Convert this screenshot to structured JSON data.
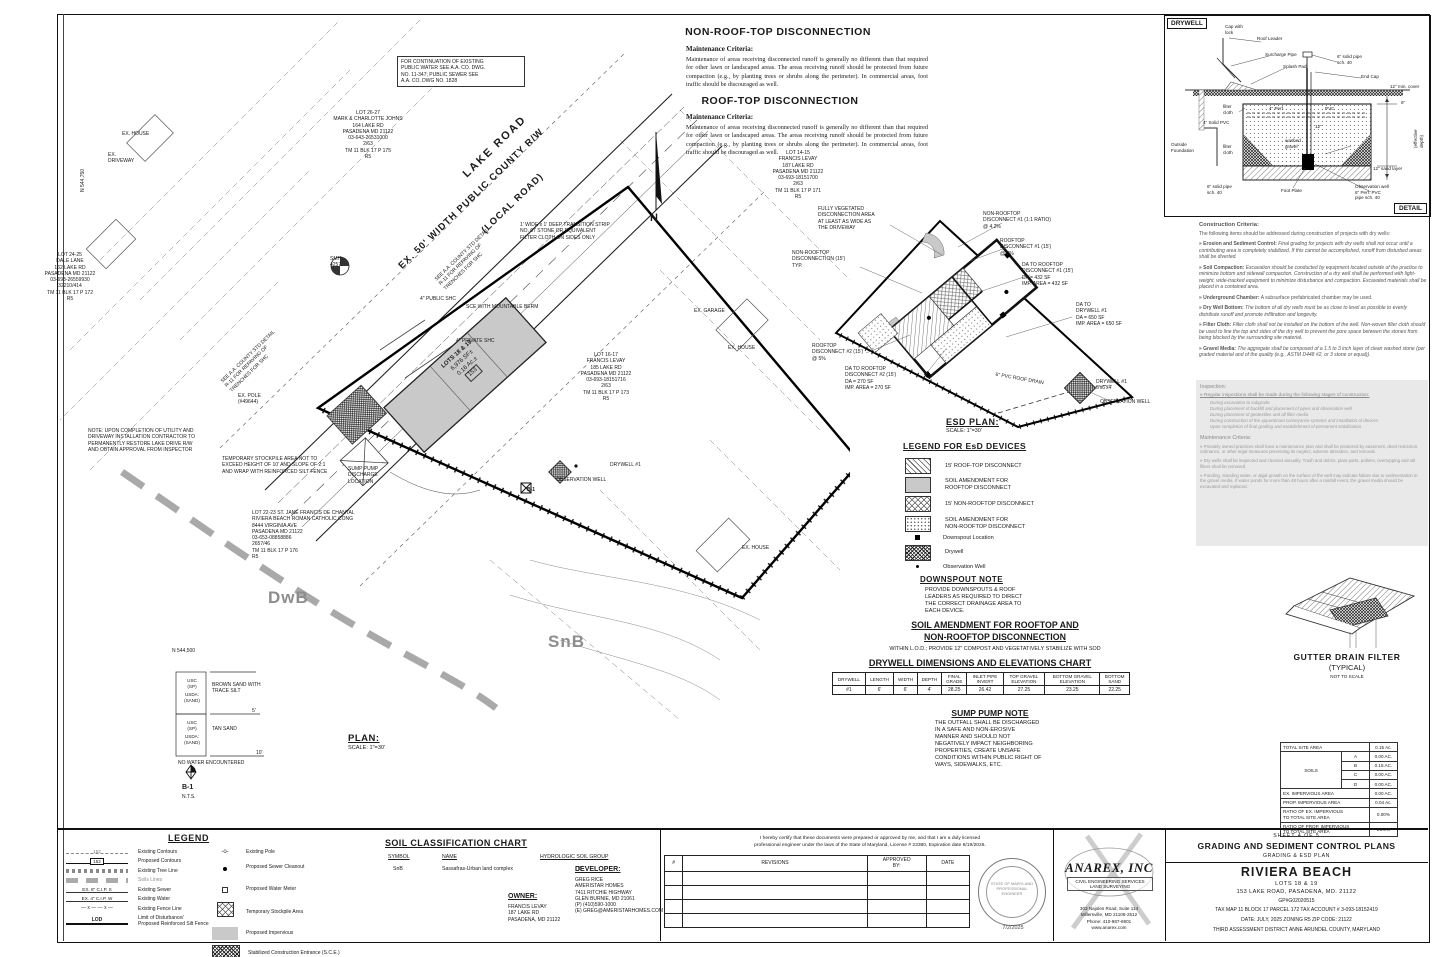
{
  "top_notes": {
    "non_rooftop_title": "NON-ROOF-TOP DISCONNECTION",
    "maintenance_label": "Maintenance Criteria:",
    "non_rooftop_body": "Maintenance of areas receiving disconnected runoff is generally no different than that required for other lawn or landscaped areas.  The areas receiving runoff should be protected from future compaction (e.g., by planting trees or shrubs along the perimeter).  In commercial areas, foot traffic should be discouraged as well.",
    "rooftop_title": "ROOF-TOP DISCONNECTION",
    "rooftop_body": "Maintenance of areas receiving disconnected runoff is generally no different than that required for other lawn or landscaped areas.  The areas receiving runoff should be protected from future compaction (e.g., by planting trees or shrubs along the perimeter).  In commercial areas, foot traffic should be discouraged as well."
  },
  "drywell_detail": {
    "title": "DRYWELL",
    "detail_label": "DETAIL",
    "labels": {
      "roof_leader": "Roof Leader",
      "surcharge_pipe": "Surcharge Pipe",
      "splash_pad": "Splash Pad",
      "cap": "Cap with\nlock",
      "solid_pipe_6": "6\" solid pipe\nsch. 40",
      "end_cap": "End Cap",
      "min_cover": "12\" min. cover",
      "filter_cloth_top": "filter\ncloth",
      "solid_pvc": "4\" Solid PVC",
      "perf_pvc": "4\" Perf.",
      "pvc": "PVC",
      "six_in": "6\"",
      "twelve_in": "12\"",
      "effective_depth": "(effective depth)",
      "outside_foundation": "Outside\nFoundation",
      "filter_cloth_side": "filter\ncloth",
      "washed_gravel": "washed\ngravel",
      "sand_layer": "12\" sand layer",
      "foot_plate": "Foot Plate",
      "observation_well": "Observation well\n6\" Perf. PVC\npipe sch. 40",
      "solid_pipe_bottom": "6\" solid pipe\nsch. 40"
    }
  },
  "criteria": {
    "title": "Construction Criteria:",
    "intro": "The following items should be addressed during construction of projects with dry wells:",
    "items": [
      {
        "name": "Erosion and Sediment Control:",
        "text": "Final grading for projects with dry wells shall not occur until a contributing area is completely stabilized.  If this cannot be accomplished, runoff from disturbed areas shall be diverted."
      },
      {
        "name": "Soil Compaction:",
        "text": "Excavation should be conducted by equipment located outside of the practice to minimize bottom and sidewall compaction.  Construction of a dry well shall be performed with light-weight, wide-tracked equipment to minimize disturbance and compaction.  Excavated materials shall be placed in a contained area."
      },
      {
        "name": "Underground Chamber:",
        "text": "A subsurface prefabricated chamber may be used."
      },
      {
        "name": "Dry Well Bottom:",
        "text": "The bottom of all dry wells must be as close to level as possible to evenly distribute runoff and promote infiltration and longevity."
      },
      {
        "name": "Filter Cloth:",
        "text": "Filter cloth shall not be installed on the bottom of the well.  Non-woven filter cloth should be used to line the top and sides of the dry well to prevent the pore space between the stones from being blocked by the surrounding site material."
      },
      {
        "name": "Gravel Media:",
        "text": "The aggregate shall be composed of a 1.5 to 3 inch layer of clean washed stone (per graded material and of the quality (e.g., ASTM D448 #2, or 3 stone or equal))."
      }
    ],
    "inspection_title": "Inspection:",
    "inspection_intro": "Regular inspections shall be made during the following stages of construction:",
    "inspection_items": [
      "During excavation to subgrade",
      "During placement of backfill and placement of pipes and observation well",
      "During placement of geotextiles and all filter media",
      "During construction of the appurtenant conveyance systems and installation of devices",
      "Upon completion of final grading and establishment of permanent stabilization"
    ],
    "maintenance_title": "Maintenance Criteria:",
    "maintenance_items": [
      "Privately owned practices shall have a maintenance plan and shall be protected by easement, deed restriction, ordinance, or other legal measures preventing its neglect, adverse alteration, and removal.",
      "Dry wells shall be inspected and cleaned annually.  Trash and debris, plant parts, pollens, overtopping and silt filters shall be removed.",
      "Ponding, standing water, or algal growth on the surface of the well may indicate failure due to sedimentation in the gravel media.  If water ponds for more than 48 hours after a rainfall event, the gravel media should be excavated and replaced."
    ]
  },
  "plan": {
    "title": "PLAN:",
    "scale": "SCALE: 1\"=30'",
    "road_label_1": "LAKE ROAD",
    "road_label_2": "EX. 50' WIDTH PUBLIC COUNTY R/W",
    "road_label_3": "(LOCAL ROAD)",
    "north_label": "N",
    "soil_dwb": "DwB",
    "soil_snb": "SnB",
    "building": {
      "line1": "LOTS 18 & 19",
      "line2": "6,976 SF±",
      "line3": "0.16 Ac.±",
      "addr": "153"
    },
    "labels": [
      "FOR CONTINUATION OF EXISTING\nPUBLIC WATER SEE A.A. CO. DWG.\nNO. 11-347; PUBLIC SEWER SEE\nA.A. CO. DWG NO. 1828",
      "LOT 26-27\nMARK & CHARLOTTE JOHNS\n164 LAKE RD\nPASADENA MD 21122\n03-643-26531000\n2/63\nTM 11 BLK 17 P 175\nR5",
      "EX. HOUSE",
      "EX.\nDRIVEWAY",
      "LOT 24-25\nDALE LANE\n162 LAKE RD\nPASADENA MD 21122\n03-693-26559930\n32210/414\nTM 11 BLK 17 P 172\nR5",
      "LOT 14-15\nFRANCIS LEVAY\n187 LAKE RD\nPASADENA MD 21122\n03-693-18151700\n2/63\nTM 11 BLK 17 P 171\nR5",
      "LOT 16-17\nFRANCIS LEVAY\n185 LAKE RD\nPASADENA MD 21122\n03-693-18151716\n2/63\nTM 11 BLK 17 P 173\nR5",
      "SMH\n4257",
      "4\" PUBLIC SHC",
      "SCE WITH MOUNTABLE BERM",
      "1' WIDE x 1' DEEP TRANSITION STRIP\nNO. 67 STONE OR EQUIVALENT\nFILTER CLOTH ON SIDES ONLY",
      "4\" PRIVATE SHC",
      "NOTE: UPON COMPLETION OF UTILITY AND\nDRIVEWAY INSTALLATION CONTRACTOR TO\nPERMANENTLY RESTORE LAKE DRIVE R/W\nAND OBTAIN APPROVAL FROM INSPECTOR",
      "TEMPORARY STOCKPILE AREA NOT TO\nEXCEED HEIGHT OF 10' AND SLOPE OF 2:1\nAND WRAP WITH REINFORCED SILT FENCE",
      "SUMP PUMP\nDISCHARGE\nLOCATION",
      "DRYWELL #1",
      "OBSERVATION WELL",
      "B-1",
      "LOT 22-23 ST. JANE FRANCIS DE CHANTAL\nRIVIERA BEACH ROMAN CATHOLIC CONG\n8444 VIRGINIA AVE\nPASADENA MD 21122\n03-653-08858886\n2657/46\nTM 11 BLK 17 P 176\nR5",
      "EX. POLE\n(#49644)",
      "EX. HOUSE",
      "EX. GARAGE",
      "N 544,750",
      "N 544,500",
      "SEE A.A. COUNTY STD DETAIL\nR-11 FOR REPAVING OF\nTRENCHES FOR SHC",
      "EX. HOUSE"
    ],
    "boring": {
      "usc": "USC\n(SP)",
      "usda": "USDA:\n(SAND)",
      "layer1": "BROWN SAND WITH\nTRACE SILT",
      "layer2": "TAN SAND",
      "d1": "5'",
      "d2": "10'",
      "no_water": "NO WATER ENCOUNTERED",
      "name": "B-1",
      "nts": "N.T.S."
    }
  },
  "esd": {
    "title": "ESD PLAN:",
    "scale": "SCALE: 1\"=30'",
    "callouts": [
      "FULLY VEGETATED\nDISCONNECTION AREA\nAT LEAST AS WIDE AS\nTHE DRIVEWAY",
      "NON-ROOFTOP\nDISCONNECT #1 (1:1 RATIO)\n@ 4.2%",
      "ROOFTOP\nDISCONNECT #1 (15')\n@ 2%",
      "DA TO ROOFTOP\nDISCONNECT #1 (15')\nDA = 432 SF\nIMP. AREA = 432 SF",
      "DA TO\nDRYWELL #1\nDA = 650 SF\nIMP. AREA = 650 SF",
      "NON-ROOFTOP\nDISCONNECTION (15')\nTYP.",
      "ROOFTOP\nDISCONNECT #2 (15')\n@ 5%",
      "DA TO ROOFTOP\nDISCONNECT #2 (15')\nDA = 270 SF\nIMP. AREA = 270 SF",
      "6\" PVC ROOF DRAIN",
      "DRYWELL #1\n6'x6'x4'",
      "OBSERVATION WELL"
    ]
  },
  "esd_legend": {
    "title": "LEGEND FOR EsD DEVICES",
    "items": [
      "15' ROOF-TOP DISCONNECT",
      "SOIL AMENDMENT FOR\nROOFTOP DISCONNECT",
      "15' NON-ROOFTOP DISCONNECT",
      "SOIL AMENDMENT FOR\nNON-ROOFTOP DISCONNECT",
      "Downspout Location",
      "Drywell",
      "Observation Well"
    ]
  },
  "notes2": {
    "downspout_title": "DOWNSPOUT NOTE",
    "downspout_body": "PROVIDE DOWNSPOUTS & ROOF\nLEADERS AS REQUIRED TO DIRECT\nTHE CORRECT DRAINAGE AREA TO\nEACH DEVICE.",
    "soil_amend_title1": "SOIL AMENDMENT FOR ROOFTOP AND",
    "soil_amend_title2": "NON-ROOFTOP DISCONNECTION",
    "soil_amend_body": "WITHIN L.O.D.; PROVIDE 12\" COMPOST AND VEGETATIVELY STABILIZE WITH SOD",
    "sump_title": "SUMP PUMP NOTE",
    "sump_body": "THE OUTFALL SHALL BE DISCHARGED\nIN A SAFE AND NON-EROSIVE\nMANNER AND SHOULD NOT\nNEGATIVELY IMPACT NEIGHBORING\nPROPERTIES, CREATE UNSAFE\nCONDITIONS WITHIN PUBLIC RIGHT OF\nWAYS, SIDEWALKS, ETC."
  },
  "drywell_chart": {
    "title": "DRYWELL DIMENSIONS AND ELEVATIONS CHART",
    "headers": [
      "DRYWELL",
      "LENGTH",
      "WIDTH",
      "DEPTH",
      "FINAL\nGRADE",
      "INLET PIPE\nINVERT",
      "TOP GRAVEL\nELEVATION",
      "BOTTOM GRAVEL\nELEVATION",
      "BOTTOM\nSAND"
    ],
    "row": [
      "#1",
      "6'",
      "6'",
      "4'",
      "28.25",
      "26.42",
      "27.25",
      "23.25",
      "22.25"
    ]
  },
  "gutter": {
    "title": "GUTTER DRAIN FILTER",
    "subtitle": "(TYPICAL)",
    "note": "NOT TO SCALE"
  },
  "site_table": {
    "total_label": "TOTAL SITE AREA",
    "total_value": "0.15 Ac.",
    "soils_label": "SOILS",
    "soil_rows": [
      [
        "A",
        "0.00 AC."
      ],
      [
        "B",
        "0.15 AC."
      ],
      [
        "C",
        "0.00 AC."
      ],
      [
        "D",
        "0.00 AC."
      ]
    ],
    "ex_imp_label": "EX. IMPERVIOUS AREA",
    "ex_imp_value": "0.00 AC.",
    "prop_imp_label": "PROP. IMPERVIOUS AREA",
    "prop_imp_value": "0.04 Ac.",
    "ratio_ex_label": "RATIO OF EX. IMPERVIOUS\nTO TOTAL SITE AREA",
    "ratio_ex_value": "0.00%",
    "ratio_prop_label": "RATIO OF PROP. IMPERVIOUS\nTO TOTAL SITE AREA",
    "ratio_prop_value": "26.6%"
  },
  "legend": {
    "title": "LEGEND",
    "sw_contour": "152",
    "sw_prop_contour": "152",
    "sw_sewer": "EX. 8\" C.I.P. S",
    "sw_water": "EX. 4\" C.I.P. W",
    "sw_lod": "LOD",
    "left": [
      "Existing Contours",
      "Proposed Contours",
      "Existing Tree Line",
      "Soils Lines",
      "Existing Sewer",
      "Existing Water",
      "Existing Fence Line",
      "Limit of Disturbance/\nProposed Reinforced Silt Fence"
    ],
    "right": [
      "Existing Pole",
      "Proposed Sewer Cleanout",
      "Proposed Water Meter",
      "Temporary Stockpile Area",
      "Proposed Impervious",
      "Stabilized Construction Entrance (S.C.E.)"
    ]
  },
  "soil_chart": {
    "title": "SOIL CLASSIFICATION CHART",
    "headers": [
      "SYMBOL",
      "NAME",
      "HYDROLOGIC SOIL GROUP"
    ],
    "rows": [
      [
        "SnB",
        "Sassafras-Urban land complex",
        "B"
      ]
    ]
  },
  "owner": {
    "label": "OWNER:",
    "lines": "FRANCIS LEVAY\n187 LAKE RD\nPASADENA, MD 21122"
  },
  "developer": {
    "label": "DEVELOPER:",
    "lines": "GREG RICE\nAMERISTAR HOMES\n7411 RITCHIE HIGHWAY\nGLEN BURNIE, MD 21061\n(P) (410)590-1000\n(E) GREG@AMERISTARHOMES.COM"
  },
  "titleblock": {
    "certification": "I hereby certify that these documents were prepared or approved by me, and that I am a duly licensed\nprofessional engineer under the laws of the State of Maryland, License # 23380, Expiration date 8/19/2026.",
    "rev_headers": [
      "#",
      "REVISIONS",
      "APPROVED\nBY:",
      "DATE"
    ],
    "seal_text": "STATE OF MARYLAND\nPROFESSIONAL ENGINEER",
    "seal_date": "7/2/2025",
    "firm": {
      "name": "ANAREX, INC",
      "services": "CIVIL ENGINEERING SERVICES\nLAND SURVEYING",
      "address": "303 Najoles Road, Suite 114\nMillersville, MD 21108-2512\nPhone: 410-987-6901\nwww.anarex.com"
    },
    "sheet": {
      "sheet_no": "SHEET 4 OF 5",
      "title": "GRADING AND SEDIMENT CONTROL PLANS",
      "subtitle": "GRADING & ESD PLAN",
      "project": "RIVIERA BEACH",
      "lots": "LOTS 18 & 19",
      "address": "153 LAKE ROAD, PASADENA, MD. 21122",
      "permit": "GP#G02020515",
      "tax": "TAX MAP 11    BLOCK 17    PARCEL 172    TAX ACCOUNT # 3-093-18152419",
      "date_line": "DATE: JULY, 2025        ZONING R5        ZIP CODE: 21122",
      "district": "THIRD    ASSESSMENT DISTRICT    ANNE ARUNDEL COUNTY, MARYLAND"
    }
  },
  "colors": {
    "line": "#1a1a1a",
    "faint": "#8d8d8d",
    "impervious_fill": "#c9c9c9",
    "panel_gray": "#e9e9e9"
  }
}
